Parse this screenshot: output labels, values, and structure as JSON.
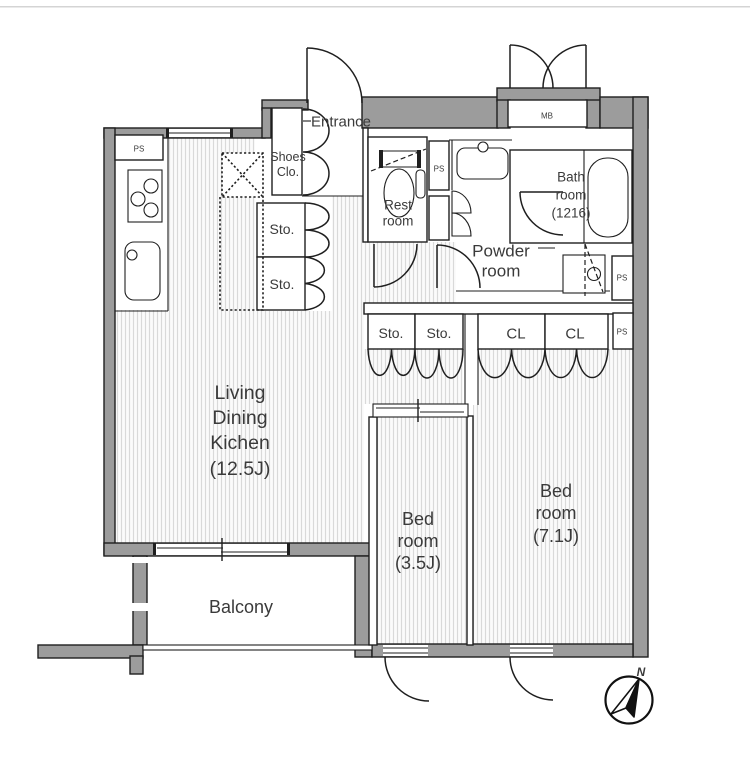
{
  "title": "apartment-floorplan",
  "colors": {
    "wall_fill": "#9c9c9c",
    "line": "#1f1f1f",
    "hatch_line": "#d9d9d9",
    "text": "#3a3a3a",
    "frame": "#d4d4d4"
  },
  "labels": {
    "entrance": "Entrance",
    "shoes1": "Shoes",
    "shoes2": "Clo.",
    "sto": "Sto.",
    "cl": "CL",
    "ps": "PS",
    "mb": "MB",
    "rest1": "Rest",
    "rest2": "room",
    "powder1": "Powder",
    "powder2": "room",
    "bath1": "Bath",
    "bath2": "room",
    "bath3": "(1216)",
    "ldk1": "Living",
    "ldk2": "Dining",
    "ldk3": "Kichen",
    "ldk4": "(12.5J)",
    "bed_small1": "Bed",
    "bed_small2": "room",
    "bed_small3": "(3.5J)",
    "bed_large1": "Bed",
    "bed_large2": "room",
    "bed_large3": "(7.1J)",
    "balcony": "Balcony",
    "north": "N"
  }
}
